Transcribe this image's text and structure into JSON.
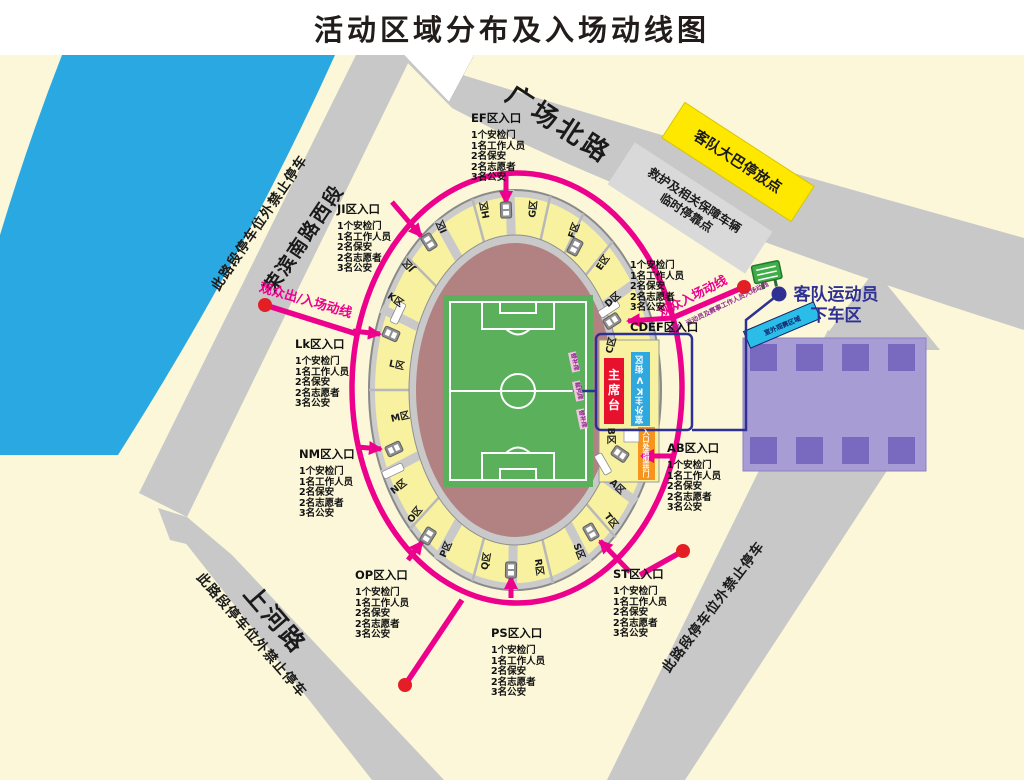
{
  "title": "活动区域分布及入场动线图",
  "roads": {
    "north": "广场北路",
    "west": "荣滨南路西段",
    "south": "上河路",
    "no_parking": "此路段停车位外禁止停车"
  },
  "facilities": {
    "bus_parking": "客队大巴停放点",
    "support_vehicles_line1": "救护及相关保障车辆",
    "support_vehicles_line2": "临时停靠点",
    "dropoff_line1": "客队运动员",
    "dropoff_line2": "下车区",
    "outdoor_sign": "室外观赛区域",
    "rostrum": "主席台",
    "kv_zone": "室外主KV街区",
    "arch": "入口处造型拱门"
  },
  "flows": {
    "spectator_exit_entry": "观众出/入场动线",
    "spectator_entry": "观众入场动线",
    "vip_entry": "嘉宾、运动员及赛事工作人员入场动线"
  },
  "entrance_lines": [
    "1个安检门",
    "1名工作人员",
    "2名保安",
    "2名志愿者",
    "3名公安"
  ],
  "entrances": [
    {
      "title": "EF区入口"
    },
    {
      "title": "JI区入口"
    },
    {
      "title": "Lk区入口"
    },
    {
      "title": "NM区入口"
    },
    {
      "title": "OP区入口"
    },
    {
      "title": "PS区入口"
    },
    {
      "title": "ST区入口"
    },
    {
      "title": "AB区入口"
    },
    {
      "title": "CDEF区入口"
    }
  ],
  "stadium": {
    "sections": [
      "A区",
      "B区",
      "C区",
      "D区",
      "E区",
      "F区",
      "G区",
      "H区",
      "I区",
      "J区",
      "K区",
      "L区",
      "M区",
      "N区",
      "O区",
      "P区",
      "Q区",
      "R区",
      "S区",
      "T区"
    ],
    "field_side": [
      "替补席",
      "裁判席",
      "替补席"
    ]
  }
}
